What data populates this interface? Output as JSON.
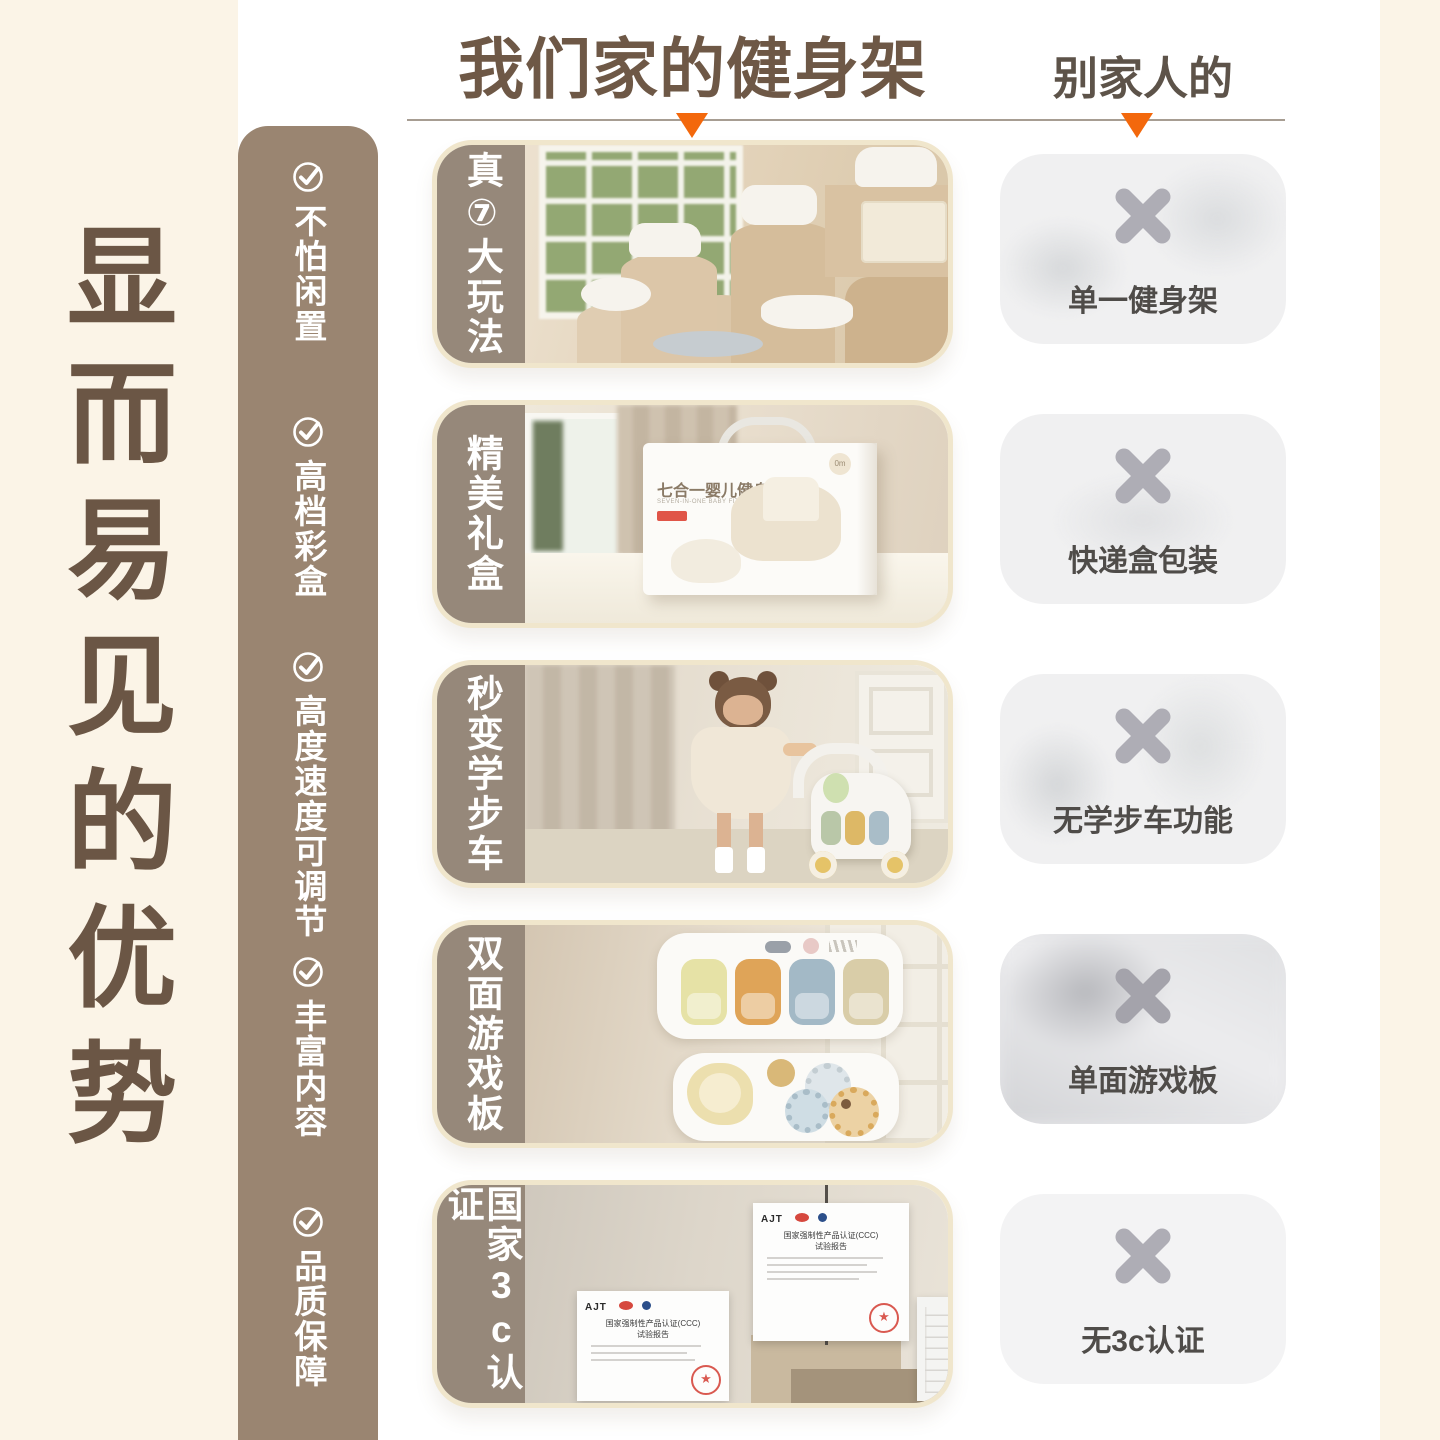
{
  "title_column": "显而易见的优势",
  "header": {
    "ours": "我们家的健身架",
    "theirs": "别家人的"
  },
  "sidebar": {
    "items": [
      {
        "label": "不怕闲置"
      },
      {
        "label": "高档彩盒"
      },
      {
        "label": "高度速度可调节"
      },
      {
        "label": "丰富内容"
      },
      {
        "label": "品质保障"
      }
    ]
  },
  "rows": [
    {
      "label": "真⑦大玩法",
      "con_caption": "单一健身架"
    },
    {
      "label": "精美礼盒",
      "con_caption": "快递盒包装"
    },
    {
      "label": "秒变学步车",
      "con_caption": "无学步车功能"
    },
    {
      "label": "双面游戏板",
      "con_caption": "单面游戏板"
    },
    {
      "label": "国家3c认证",
      "con_caption": "无3c认证"
    }
  ],
  "giftbox": {
    "title": "七合一婴儿健身架",
    "subtitle": "SEVEN-IN-ONE BABY FITNESS GYM",
    "badge": "0m"
  },
  "certificate": {
    "logo": "AJT",
    "title": "国家强制性产品认证(CCC)",
    "subtitle": "试验报告",
    "stamp_star": "★"
  },
  "colors": {
    "accent_orange": "#f3680c",
    "brand_brown": "#6e5846",
    "sidebar_brown": "#9a8571",
    "strip_brown": "#96887a",
    "cream_bg": "#fbf4e7",
    "x_gray": "#aeadb5",
    "caption_gray": "#4f4c49"
  }
}
